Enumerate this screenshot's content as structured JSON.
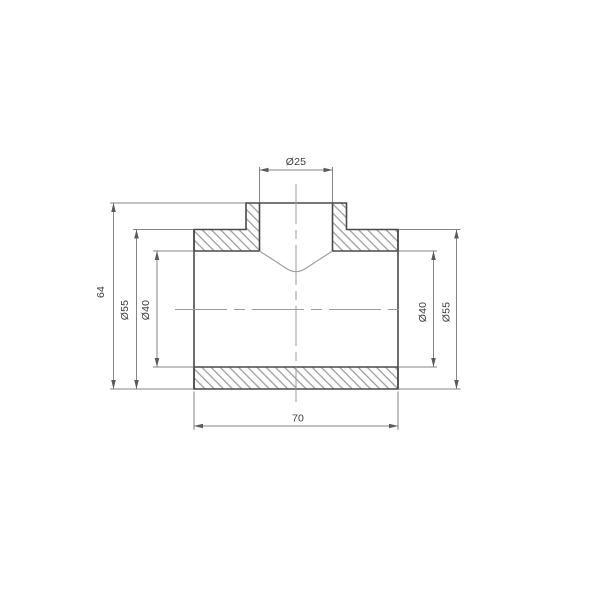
{
  "drawing": {
    "description": "pipe-tee-fitting-cross-section",
    "dimensions": {
      "top_diameter": "Ø25",
      "overall_height": "64",
      "left_outer_diameter": "Ø55",
      "left_inner_diameter": "Ø40",
      "right_inner_diameter": "Ø40",
      "right_outer_diameter": "Ø55",
      "overall_length": "70"
    },
    "colors": {
      "background": "#ffffff",
      "outline": "#4a4a4a",
      "hatch": "#9a9a9a",
      "dimension": "#858585",
      "arrow": "#5a5a5a",
      "centerline": "#9b9b9b",
      "cone_edge": "#a0a0a0",
      "text": "#3d3d3d"
    }
  }
}
